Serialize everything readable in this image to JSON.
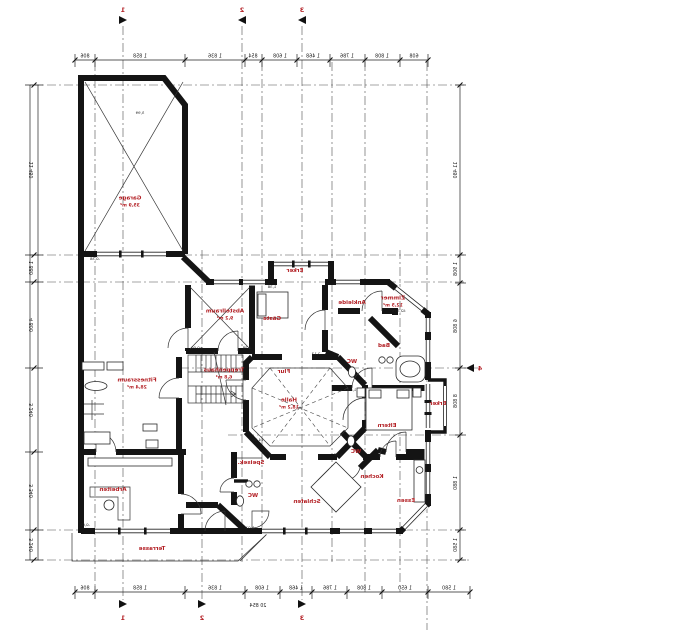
{
  "drawing": {
    "kind": "architectural floor plan",
    "label_color": "#b32025",
    "wall_color": "#141414"
  },
  "rooms": [
    {
      "name": "garage-label",
      "x": 130,
      "y": 203,
      "lines": [
        "Garage",
        "35,9 m²"
      ]
    },
    {
      "name": "fitness-label",
      "x": 137,
      "y": 385,
      "lines": [
        "Fitnessraum",
        "28,4 m²"
      ]
    },
    {
      "name": "arbeiten-label",
      "x": 113,
      "y": 491,
      "lines": [
        "Arbeiten"
      ]
    },
    {
      "name": "terrasse-label",
      "x": 152,
      "y": 550,
      "lines": [
        "Terrasse"
      ]
    },
    {
      "name": "abstellraum-label",
      "x": 225,
      "y": 316,
      "lines": [
        "Abstellraum",
        "9,2 m²"
      ]
    },
    {
      "name": "gaeste-label",
      "x": 272,
      "y": 320,
      "lines": [
        "Gäste"
      ]
    },
    {
      "name": "erker-top-label",
      "x": 295,
      "y": 272,
      "lines": [
        "Erker"
      ]
    },
    {
      "name": "ankleide-label",
      "x": 352,
      "y": 304,
      "lines": [
        "Ankleide"
      ]
    },
    {
      "name": "zimmer-label",
      "x": 393,
      "y": 303,
      "lines": [
        "Zimmer",
        "12,5 m²"
      ]
    },
    {
      "name": "bad-label",
      "x": 384,
      "y": 347,
      "lines": [
        "Bad"
      ]
    },
    {
      "name": "wc-bad-label",
      "x": 352,
      "y": 363,
      "lines": [
        "WC"
      ]
    },
    {
      "name": "treppenhaus-label",
      "x": 224,
      "y": 375,
      "lines": [
        "Treppenhaus",
        "6,8 m²"
      ]
    },
    {
      "name": "flur-label",
      "x": 284,
      "y": 373,
      "lines": [
        "Flur"
      ]
    },
    {
      "name": "halle-label",
      "x": 289,
      "y": 405,
      "lines": [
        "Halle",
        "18,2 m²"
      ]
    },
    {
      "name": "eltern-label",
      "x": 387,
      "y": 427,
      "lines": [
        "Eltern"
      ]
    },
    {
      "name": "erker-right-label",
      "x": 438,
      "y": 405,
      "lines": [
        "Erker"
      ]
    },
    {
      "name": "wc-mid-label",
      "x": 356,
      "y": 453,
      "lines": [
        "WC"
      ]
    },
    {
      "name": "speisekammer-label",
      "x": 251,
      "y": 464,
      "lines": [
        "Speisek."
      ]
    },
    {
      "name": "wc-bottom-label",
      "x": 253,
      "y": 497,
      "lines": [
        "WC"
      ]
    },
    {
      "name": "schlafen-label",
      "x": 307,
      "y": 503,
      "lines": [
        "Schlafen"
      ]
    },
    {
      "name": "kochen-label",
      "x": 372,
      "y": 478,
      "lines": [
        "Kochen"
      ]
    },
    {
      "name": "essen-label",
      "x": 406,
      "y": 502,
      "lines": [
        "Essen"
      ]
    }
  ],
  "annotations": [
    {
      "x": 140,
      "y": 114,
      "text": "5,99"
    },
    {
      "x": 95,
      "y": 260,
      "text": "-0,38"
    },
    {
      "x": 197,
      "y": 349,
      "text": "±0,00"
    },
    {
      "x": 247,
      "y": 349,
      "text": "4,38"
    },
    {
      "x": 258,
      "y": 441,
      "text": "14,30"
    },
    {
      "x": 316,
      "y": 355,
      "text": "2,13"
    },
    {
      "x": 352,
      "y": 391,
      "text": "1,88"
    },
    {
      "x": 272,
      "y": 288,
      "text": "1,38"
    },
    {
      "x": 338,
      "y": 456,
      "text": "0,88"
    },
    {
      "x": 250,
      "y": 529,
      "text": "1,01"
    },
    {
      "x": 85,
      "y": 526,
      "text": "-0,02"
    },
    {
      "x": 398,
      "y": 312,
      "text": "42,5 m³"
    }
  ],
  "dimensions": {
    "top": {
      "entries": [
        {
          "x": 85,
          "text": "806"
        },
        {
          "x": 140,
          "text": "1 858"
        },
        {
          "x": 215,
          "text": "1 836"
        },
        {
          "x": 253,
          "text": "854"
        },
        {
          "x": 280,
          "text": "1 608"
        },
        {
          "x": 313,
          "text": "1 468"
        },
        {
          "x": 347,
          "text": "1 786"
        },
        {
          "x": 382,
          "text": "1 808"
        },
        {
          "x": 414,
          "text": "608"
        }
      ]
    },
    "bottom": {
      "entries": [
        {
          "x": 85,
          "text": "806"
        },
        {
          "x": 140,
          "text": "1 858"
        },
        {
          "x": 215,
          "text": "1 836"
        },
        {
          "x": 262,
          "text": "1 608"
        },
        {
          "x": 296,
          "text": "1 468"
        },
        {
          "x": 330,
          "text": "1 786"
        },
        {
          "x": 364,
          "text": "1 808"
        },
        {
          "x": 405,
          "text": "1 650"
        },
        {
          "x": 449,
          "text": "1 580"
        }
      ],
      "overall": {
        "x": 258,
        "y": 601,
        "text": "20 854"
      }
    },
    "left": {
      "entries": [
        {
          "y": 170,
          "text": "11 480"
        },
        {
          "y": 268,
          "text": "1 880"
        },
        {
          "y": 325,
          "text": "4 800"
        },
        {
          "y": 410,
          "text": "3 240"
        },
        {
          "y": 491,
          "text": "3 340"
        },
        {
          "y": 545,
          "text": "3 240"
        }
      ]
    },
    "right": {
      "entries": [
        {
          "y": 170,
          "text": "11 480"
        },
        {
          "y": 269,
          "text": "1 908"
        },
        {
          "y": 326,
          "text": "6 808"
        },
        {
          "y": 401,
          "text": "8 808"
        },
        {
          "y": 483,
          "text": "1 880"
        },
        {
          "y": 545,
          "text": "1 580"
        }
      ]
    }
  },
  "section_markers": {
    "top": [
      {
        "x": 123,
        "label": "1"
      },
      {
        "x": 242,
        "label": "2"
      },
      {
        "x": 302,
        "label": "3"
      }
    ],
    "bottom": [
      {
        "x": 123,
        "label": "1"
      },
      {
        "x": 202,
        "label": "2"
      },
      {
        "x": 302,
        "label": "3"
      }
    ],
    "right": [
      {
        "x": 472,
        "y": 368,
        "label": "4"
      }
    ]
  }
}
